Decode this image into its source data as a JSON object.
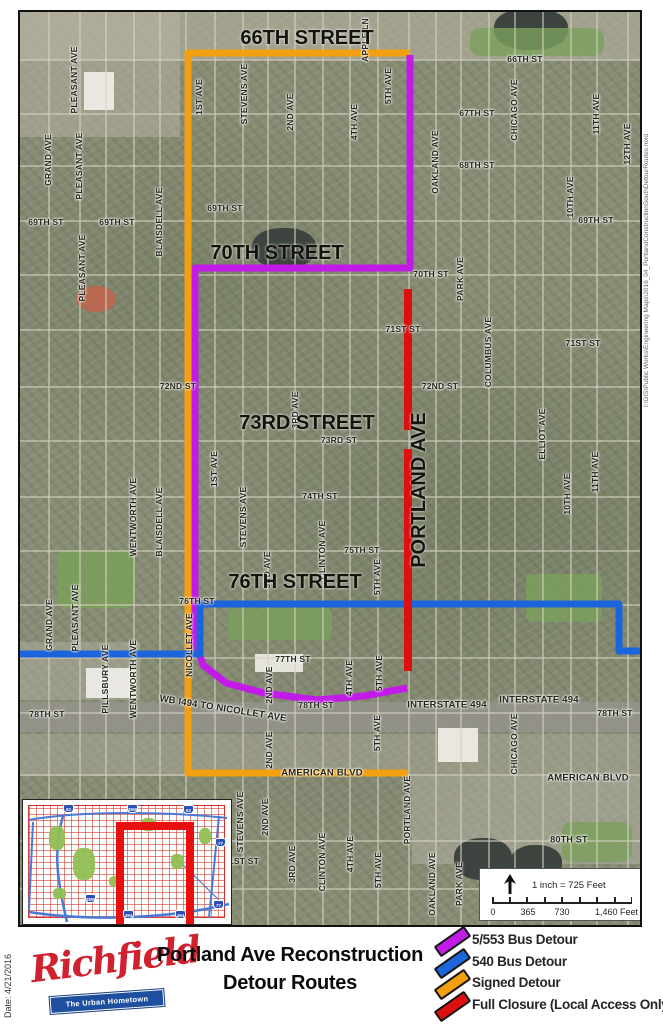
{
  "map": {
    "date_text": "Date: 4/21/2016",
    "credit_text": "I:\\GIS\\Public Works\\Engineering Maps\\2016_04_PortlandConstructionSouthDetourRoutes.mxd",
    "big_labels": [
      {
        "t": "66TH STREET",
        "x": 305,
        "y": 36
      },
      {
        "t": "70TH STREET",
        "x": 275,
        "y": 251
      },
      {
        "t": "73RD STREET",
        "x": 305,
        "y": 421
      },
      {
        "t": "76TH STREET",
        "x": 293,
        "y": 580
      },
      {
        "t": "PORTLAND AVE",
        "x": 417,
        "y": 488,
        "v": 1
      }
    ],
    "street_labels": [
      {
        "t": "PLEASANT AVE",
        "x": 72,
        "y": 78,
        "v": 1
      },
      {
        "t": "GRAND AVE",
        "x": 46,
        "y": 158,
        "v": 1
      },
      {
        "t": "PLEASANT AVE",
        "x": 77,
        "y": 164,
        "v": 1
      },
      {
        "t": "PLEASANT AVE",
        "x": 80,
        "y": 266,
        "v": 1
      },
      {
        "t": "BLAISDELL AVE",
        "x": 157,
        "y": 220,
        "v": 1
      },
      {
        "t": "1ST AVE",
        "x": 197,
        "y": 95,
        "v": 1
      },
      {
        "t": "STEVENS AVE",
        "x": 242,
        "y": 92,
        "v": 1
      },
      {
        "t": "2ND AVE",
        "x": 288,
        "y": 110,
        "v": 1
      },
      {
        "t": "APPLE LN",
        "x": 363,
        "y": 38,
        "v": 1
      },
      {
        "t": "4TH AVE",
        "x": 352,
        "y": 120,
        "v": 1
      },
      {
        "t": "5TH AVE",
        "x": 386,
        "y": 84,
        "v": 1
      },
      {
        "t": "CHICAGO AVE",
        "x": 512,
        "y": 108,
        "v": 1
      },
      {
        "t": "OAKLAND AVE",
        "x": 433,
        "y": 160,
        "v": 1
      },
      {
        "t": "11TH AVE",
        "x": 594,
        "y": 112,
        "v": 1
      },
      {
        "t": "12TH AVE",
        "x": 625,
        "y": 142,
        "v": 1
      },
      {
        "t": "10TH AVE",
        "x": 568,
        "y": 195,
        "v": 1
      },
      {
        "t": "66TH ST",
        "x": 523,
        "y": 57
      },
      {
        "t": "67TH ST",
        "x": 475,
        "y": 111
      },
      {
        "t": "68TH ST",
        "x": 475,
        "y": 163
      },
      {
        "t": "69TH ST",
        "x": 44,
        "y": 220
      },
      {
        "t": "69TH ST",
        "x": 115,
        "y": 220
      },
      {
        "t": "69TH ST",
        "x": 223,
        "y": 206
      },
      {
        "t": "69TH ST",
        "x": 594,
        "y": 218
      },
      {
        "t": "70TH ST",
        "x": 429,
        "y": 272
      },
      {
        "t": "PARK AVE",
        "x": 458,
        "y": 277,
        "v": 1
      },
      {
        "t": "71ST ST",
        "x": 401,
        "y": 327
      },
      {
        "t": "71ST ST",
        "x": 581,
        "y": 341
      },
      {
        "t": "COLUMBUS AVE",
        "x": 486,
        "y": 350,
        "v": 1
      },
      {
        "t": "72ND ST",
        "x": 176,
        "y": 384
      },
      {
        "t": "72ND ST",
        "x": 438,
        "y": 384
      },
      {
        "t": "73RD ST",
        "x": 337,
        "y": 438
      },
      {
        "t": "3RD AVE",
        "x": 293,
        "y": 408,
        "v": 1
      },
      {
        "t": "ELLIOT AVE",
        "x": 540,
        "y": 432,
        "v": 1
      },
      {
        "t": "11TH AVE",
        "x": 593,
        "y": 470,
        "v": 1
      },
      {
        "t": "10TH AVE",
        "x": 565,
        "y": 492,
        "v": 1
      },
      {
        "t": "1ST AVE",
        "x": 212,
        "y": 467,
        "v": 1
      },
      {
        "t": "STEVENS AVE",
        "x": 241,
        "y": 515,
        "v": 1
      },
      {
        "t": "WENTWORTH AVE",
        "x": 131,
        "y": 515,
        "v": 1
      },
      {
        "t": "BLAISDELL AVE",
        "x": 157,
        "y": 520,
        "v": 1
      },
      {
        "t": "74TH ST",
        "x": 318,
        "y": 494
      },
      {
        "t": "CLINTON AVE",
        "x": 320,
        "y": 548,
        "v": 1
      },
      {
        "t": "75TH ST",
        "x": 360,
        "y": 548
      },
      {
        "t": "3RD AVE",
        "x": 265,
        "y": 568,
        "v": 1
      },
      {
        "t": "5TH AVE",
        "x": 375,
        "y": 575,
        "v": 1
      },
      {
        "t": "76TH ST",
        "x": 195,
        "y": 599
      },
      {
        "t": "GRAND AVE",
        "x": 47,
        "y": 623,
        "v": 1
      },
      {
        "t": "PLEASANT AVE",
        "x": 73,
        "y": 616,
        "v": 1
      },
      {
        "t": "PILLSBURY AVE",
        "x": 103,
        "y": 677,
        "v": 1
      },
      {
        "t": "WENTWORTH AVE",
        "x": 131,
        "y": 677,
        "v": 1
      },
      {
        "t": "NICOLLET AVE",
        "x": 187,
        "y": 643,
        "v": 1
      },
      {
        "t": "77TH ST",
        "x": 291,
        "y": 657
      },
      {
        "t": "2ND AVE",
        "x": 267,
        "y": 683,
        "v": 1
      },
      {
        "t": "4TH AVE",
        "x": 347,
        "y": 676,
        "v": 1
      },
      {
        "t": "5TH AVE",
        "x": 377,
        "y": 671,
        "v": 1
      },
      {
        "t": "WB I494 TO NICOLLET AVE",
        "x": 221,
        "y": 707,
        "rot": 9,
        "s": 9.5
      },
      {
        "t": "78TH ST",
        "x": 45,
        "y": 712
      },
      {
        "t": "78TH ST",
        "x": 314,
        "y": 703
      },
      {
        "t": "78TH ST",
        "x": 613,
        "y": 711
      },
      {
        "t": "INTERSTATE 494",
        "x": 445,
        "y": 703,
        "s": 9.5
      },
      {
        "t": "INTERSTATE 494",
        "x": 537,
        "y": 698,
        "s": 9.5
      },
      {
        "t": "2ND AVE",
        "x": 267,
        "y": 748,
        "v": 1
      },
      {
        "t": "5TH AVE",
        "x": 375,
        "y": 731,
        "v": 1
      },
      {
        "t": "CHICAGO AVE",
        "x": 512,
        "y": 742,
        "v": 1
      },
      {
        "t": "AMERICAN BLVD",
        "x": 320,
        "y": 771,
        "s": 9.5
      },
      {
        "t": "AMERICAN BLVD",
        "x": 586,
        "y": 776,
        "s": 9.5
      },
      {
        "t": "PORTLAND AVE",
        "x": 405,
        "y": 808,
        "v": 1
      },
      {
        "t": "80TH ST",
        "x": 567,
        "y": 838,
        "s": 9
      },
      {
        "t": "STEVENS AVE",
        "x": 238,
        "y": 820,
        "v": 1
      },
      {
        "t": "2ND AVE",
        "x": 263,
        "y": 815,
        "v": 1
      },
      {
        "t": "1ST ST",
        "x": 242,
        "y": 859
      },
      {
        "t": "3RD AVE",
        "x": 290,
        "y": 862,
        "v": 1
      },
      {
        "t": "CLINTON AVE",
        "x": 320,
        "y": 860,
        "v": 1
      },
      {
        "t": "4TH AVE",
        "x": 348,
        "y": 852,
        "v": 1
      },
      {
        "t": "5TH AVE",
        "x": 376,
        "y": 868,
        "v": 1
      },
      {
        "t": "OAKLAND AVE",
        "x": 430,
        "y": 882,
        "v": 1
      },
      {
        "t": "PARK AVE",
        "x": 457,
        "y": 882,
        "v": 1
      }
    ],
    "routes": [
      {
        "name": "signed-detour-route",
        "color": "#F2A010",
        "width": 7,
        "lines": [
          [
            [
              408,
              51
            ],
            [
              186,
              51
            ],
            [
              186,
              771
            ],
            [
              406,
              771
            ]
          ]
        ]
      },
      {
        "name": "5-553-bus-detour-route",
        "color": "#C21BE8",
        "width": 7,
        "lines": [
          [
            [
              408,
              53
            ],
            [
              408,
              266
            ],
            [
              193,
              266
            ],
            [
              193,
              640
            ],
            [
              201,
              663
            ],
            [
              224,
              681
            ],
            [
              262,
              691
            ],
            [
              315,
              698
            ],
            [
              362,
              694
            ],
            [
              405,
              686
            ]
          ]
        ]
      },
      {
        "name": "540-bus-detour-route",
        "color": "#1C64DC",
        "width": 7,
        "lines": [
          [
            [
              18,
              652
            ],
            [
              198,
              652
            ],
            [
              198,
              602
            ],
            [
              617,
              602
            ],
            [
              617,
              649
            ],
            [
              640,
              649
            ]
          ]
        ]
      },
      {
        "name": "full-closure-route",
        "color": "#DE0F0F",
        "width": 8,
        "lines": [
          [
            [
              406,
              287
            ],
            [
              406,
              428
            ]
          ],
          [
            [
              406,
              447
            ],
            [
              406,
              669
            ]
          ]
        ]
      }
    ],
    "inset": {
      "shields": [
        {
          "t": "62",
          "x": 40,
          "y": 4
        },
        {
          "t": "35W",
          "x": 104,
          "y": 4
        },
        {
          "t": "62",
          "x": 160,
          "y": 5
        },
        {
          "t": "77",
          "x": 192,
          "y": 38
        },
        {
          "t": "35W",
          "x": 62,
          "y": 94
        },
        {
          "t": "494",
          "x": 100,
          "y": 110
        },
        {
          "t": "494",
          "x": 152,
          "y": 110
        },
        {
          "t": "77",
          "x": 190,
          "y": 100
        }
      ]
    },
    "scalebar": {
      "ratio_label": "1 inch = 725 Feet",
      "tick_labels": [
        "0",
        "365",
        "730"
      ],
      "end_label": "1,460 Feet"
    }
  },
  "footer": {
    "logo_name": "Richfield",
    "logo_tagline": "The Urban Hometown",
    "title_line1": "Portland Ave Reconstruction",
    "title_line2": "Detour Routes",
    "legend": [
      {
        "label": "5/553 Bus Detour",
        "color": "#C21BE8"
      },
      {
        "label": "540 Bus Detour",
        "color": "#1C64DC"
      },
      {
        "label": "Signed Detour",
        "color": "#F2A010"
      },
      {
        "label": "Full Closure (Local Access Only)",
        "color": "#DE0F0F"
      }
    ]
  }
}
